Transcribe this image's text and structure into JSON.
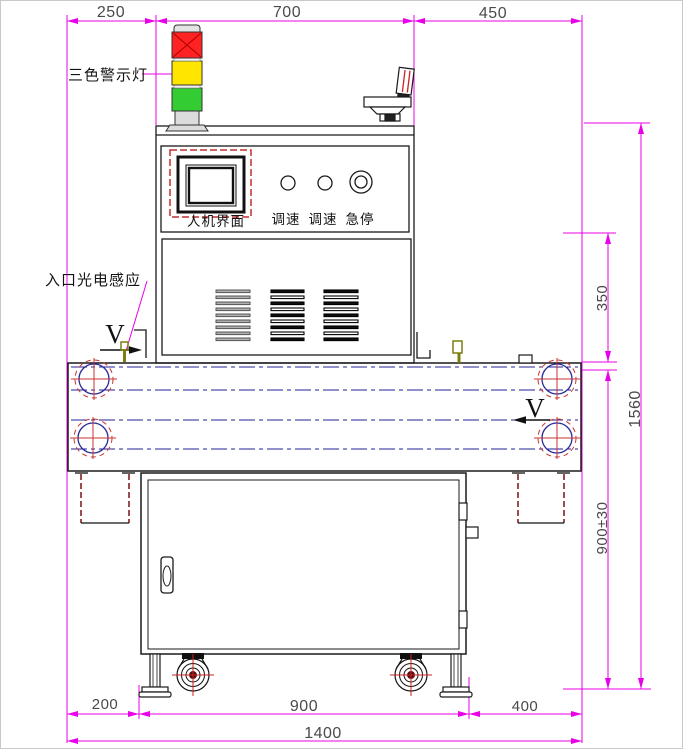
{
  "labels": {
    "tower_light": "三色警示灯",
    "entry_sensor": "入口光电感应",
    "hmi": "人机界面",
    "speed_knob_1": "调速",
    "speed_knob_2": "调速",
    "estop": "急停",
    "belt_direction_left": "V",
    "belt_direction_right": "V"
  },
  "dimensions": {
    "top": [
      "250",
      "700",
      "450"
    ],
    "right_350": "350",
    "right_1560": "1560",
    "right_900": "900±30",
    "bottom_200": "200",
    "bottom_900": "900",
    "bottom_400": "400",
    "bottom_1400": "1400"
  },
  "colors": {
    "dimension_magenta": "#e800e8",
    "outline_black": "#1a1a1a",
    "belt_centerline_navy": "#22229a",
    "roller_mark_red": "#cc3333",
    "tower_red": "#ff2222",
    "tower_yellow": "#ffe500",
    "tower_green": "#33cc33",
    "sensor_olive": "#7d7d10",
    "hmi_frame_red": "#c03030",
    "support_dashed_darkred": "#7a1212"
  }
}
